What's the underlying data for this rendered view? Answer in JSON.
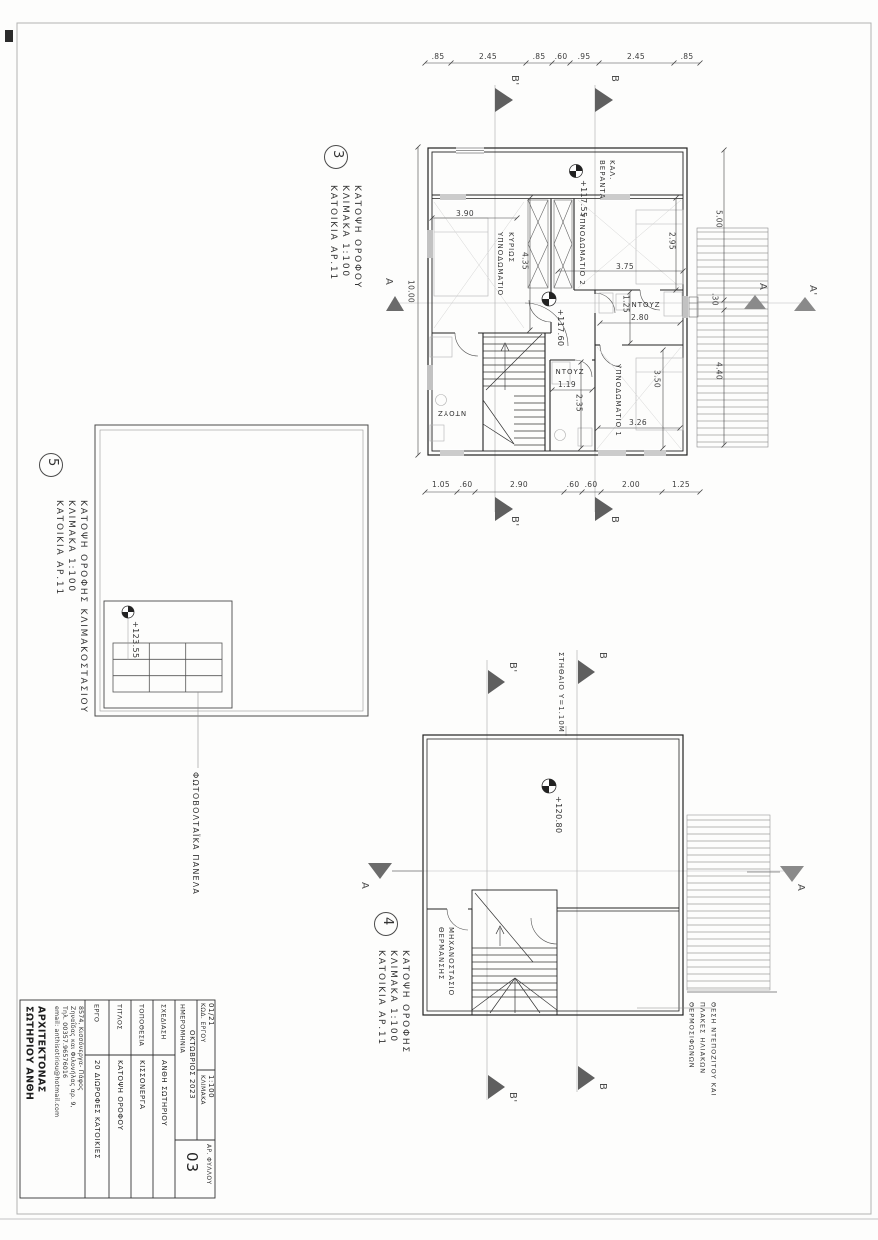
{
  "markers": {
    "a": "Α",
    "a2": "Α'",
    "b": "Β",
    "b2": "Β'"
  },
  "plans": {
    "plan3": {
      "number": "3",
      "title": "ΚΑΤΟΨΗ ΟΡΟΦΟΥ",
      "scale": "ΚΛΙΜΑΚΑ 1:100",
      "unit": "ΚΑΤΟΙΚΙΑ ΑΡ.11",
      "dims_top": [
        ".85",
        "2.45",
        ".85",
        ".60",
        ".95",
        "2.45",
        ".85"
      ],
      "dims_bottom": [
        "1.05",
        ".60",
        "2.90",
        ".60",
        ".60",
        "2.00",
        "1.25"
      ],
      "dim_left": "10.00",
      "dims_right": [
        "5.00",
        ".30",
        "4.40"
      ],
      "dims_inner": {
        "w390": "3.90",
        "h435": "4.35",
        "w375": "3.75",
        "h295": "2.95",
        "w280": "2.80",
        "h125": "1.25",
        "w119": "1.19",
        "h235": "2.35",
        "w326": "3.26",
        "h350": "3.50"
      },
      "rooms": {
        "master1": "ΚΥΡΙΩΣ",
        "master2": "ΥΠΝΟΔΩΜΑΤΙΟ",
        "bed2": "ΥΠΝΟΔΩΜΑΤΙΟ 2",
        "bed1": "ΥΠΝΟΔΩΜΑΤΙΟ 1",
        "shower1": "ΝΤΟΥΖ",
        "shower2": "ΝΤΟΥΖ",
        "shower3": "ΝΤΟΥΖ",
        "veranda1": "ΚΑΛ.",
        "veranda2": "ΒΕΡΑΝΤΑ"
      },
      "elev_veranda": "+117.55",
      "elev_floor": "+117.60"
    },
    "plan4": {
      "number": "4",
      "title": "ΚΑΤΟΨΗ ΟΡΟΦΗΣ",
      "scale": "ΚΛΙΜΑΚΑ 1:100",
      "unit": "ΚΑΤΟΙΚΙΑ ΑΡ.11",
      "elevation": "+120.80",
      "parapet": "ΣΤΗΘΑΙΟ Υ=1.10Μ",
      "room1": "ΜΗΧΑΝΟΣΤΑΣΙΟ",
      "room2": "ΘΕΡΜΑΝΣΗΣ",
      "note1": "ΘΕΣΗ ΝΤΕΠΟΖΙΤΟΥ ΚΑΙ",
      "note2": "ΠΛΑΚΕΣ ΗΛΙΑΚΩΝ",
      "note3": "ΘΕΡΜΟΣΙΦΩΝΩΝ"
    },
    "plan5": {
      "number": "5",
      "title": "ΚΑΤΟΨΗ ΟΡΟΦΗΣ ΚΛΙΜΑΚΟΣΤΑΣΙΟΥ",
      "scale": "ΚΛΙΜΑΚΑ 1:100",
      "unit": "ΚΑΤΟΙΚΙΑ ΑΡ.11",
      "elevation": "+123.55",
      "note": "ΦΩΤΟΒΟΛΤΑΪΚΑ ΠΑΝΕΛΑ"
    }
  },
  "title_block": {
    "name1": "ΣΩΤΗΡΙΟΥ ΑΝΘΗ",
    "name2": "ΑΡΧΙΤΕΚΤΟΝΑΣ",
    "email": "email: anthisotiriou@hotmail.com",
    "phone": "Τηλ. 00357.96576016",
    "addr1": "Ζηναΐδας και Φιλονήλας αρ. 9,",
    "addr2": "8574, Κισσόνεργα- Πάφος",
    "f1_label": "ΕΡΓΟ",
    "f1_value": "20 ΔΙΩΡΟΦΕΣ ΚΑΤΟΙΚΙΕΣ",
    "f2_label": "ΤΙΤΛΟΣ",
    "f2_value": "ΚΑΤΟΨΗ ΟΡΟΦΟΥ",
    "f3_label": "ΤΟΠΟΘΕΣΙΑ",
    "f3_value": "ΚΙΣΣΟΝΕΡΓΑ",
    "f4_label": "ΣΧΕΔΙΑΣΗ",
    "f4_value": "ΑΝΘΗ ΣΩΤΗΡΙΟΥ",
    "f5_label": "ΗΜΕΡΟΜΗΝΙΑ",
    "f5_value": "ΟΚΤΩΒΡΙΟΣ 2023",
    "code_label": "ΚΩΔ. ΕΡΓΟΥ",
    "code_value": "01/21",
    "scale_label": "ΚΛΙΜΑΚΑ",
    "scale_value": "1:100",
    "sheet_label": "ΑΡ. ΦΥΛΛΟΥ",
    "sheet_value": "03"
  }
}
